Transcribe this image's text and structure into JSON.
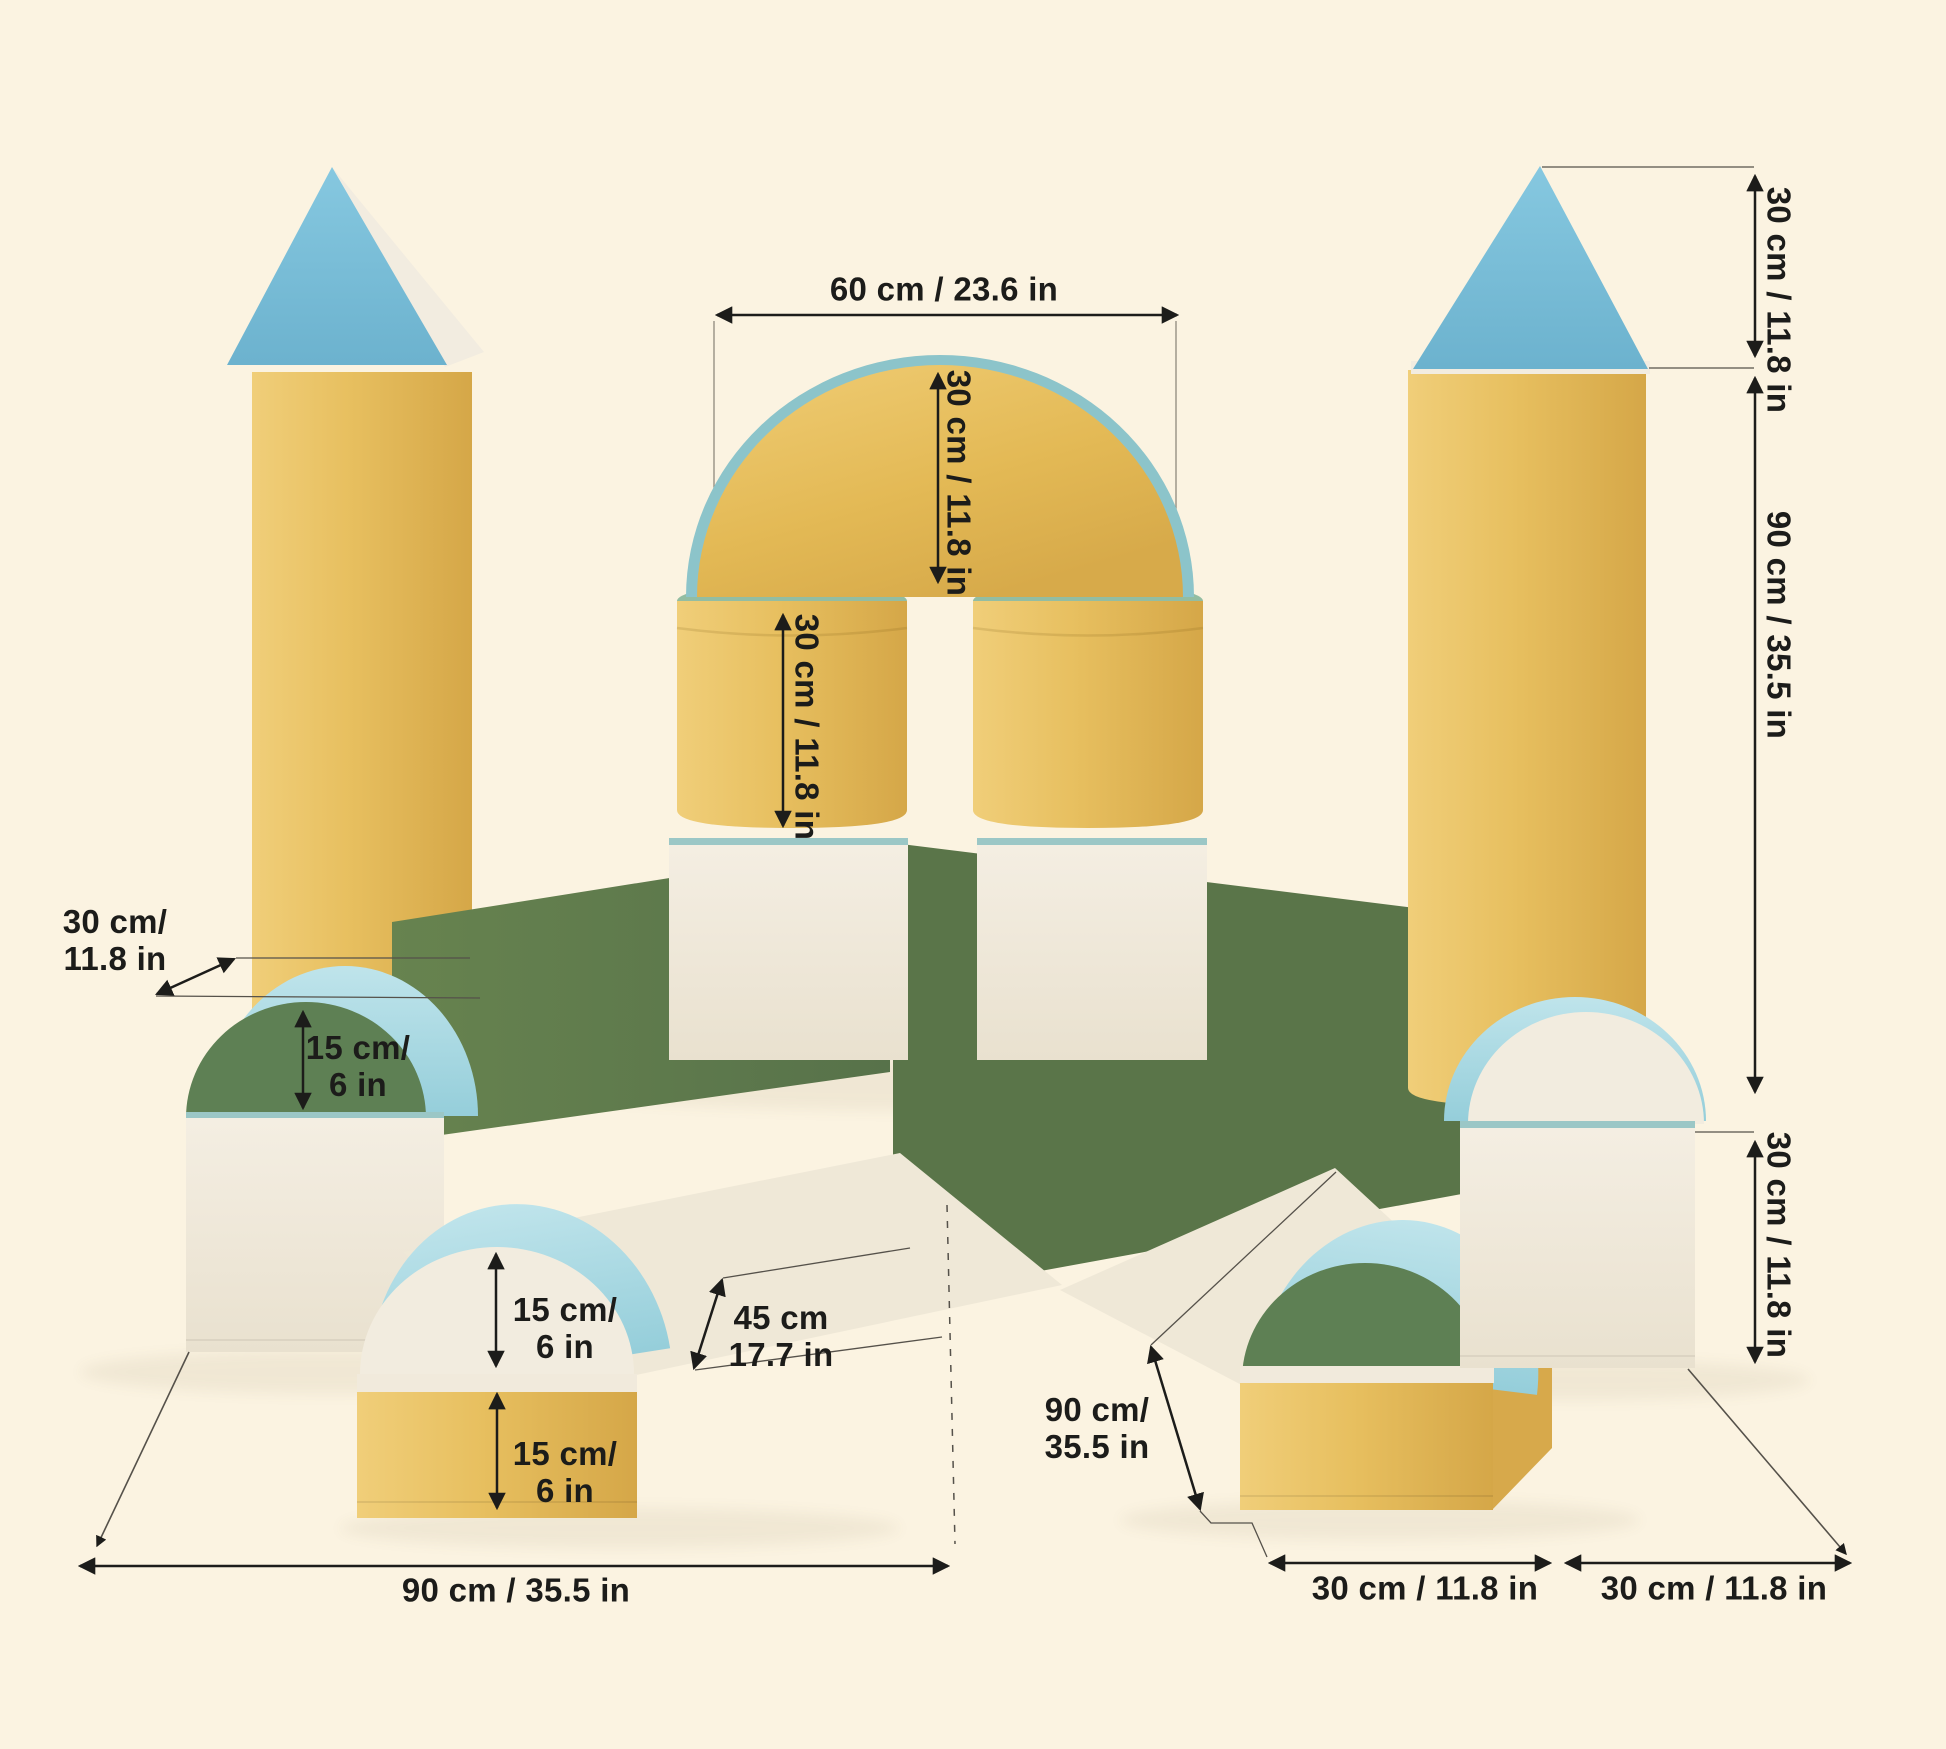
{
  "page": {
    "title": "Soft play foam blocks castle set — dimensions diagram"
  },
  "colors": {
    "background": "#FBF3E1",
    "yellow_block": "#E7BF5F",
    "blue_roof": "#7EC1DB",
    "pale_blue_block": "#A9D9E1",
    "green_block": "#5E7A4D",
    "cream_block": "#F1EADD",
    "annotation_text": "#1C1C1A"
  },
  "dimensions": {
    "arch_width": {
      "text": "60 cm / 23.6 in"
    },
    "arch_height": {
      "text": "30 cm / 11.8 in"
    },
    "pillar_height": {
      "text": "30 cm / 11.8 in"
    },
    "left_half_cylinder_depth": {
      "line1": "30 cm/",
      "line2": "11.8 in"
    },
    "left_half_cylinder_height": {
      "line1": "15 cm/",
      "line2": "6 in"
    },
    "ramp_half_cylinder_height": {
      "line1": "15 cm/",
      "line2": "6 in"
    },
    "ramp_block_height": {
      "line1": "15 cm/",
      "line2": "6 in"
    },
    "ramp_length": {
      "line1": "45 cm",
      "line2": "17.7 in"
    },
    "right_wing_length": {
      "line1": "90 cm/",
      "line2": "35.5 in"
    },
    "left_wing_length": {
      "text": "90 cm / 35.5 in"
    },
    "floor_depth_left": {
      "text": "30 cm / 11.8 in"
    },
    "floor_depth_right": {
      "text": "30 cm / 11.8 in"
    },
    "cone_height": {
      "text": "30 cm / 11.8 in"
    },
    "tower_height": {
      "text": "90 cm / 35.5 in"
    },
    "right_cube_height": {
      "text": "30 cm / 11.8 in"
    }
  }
}
